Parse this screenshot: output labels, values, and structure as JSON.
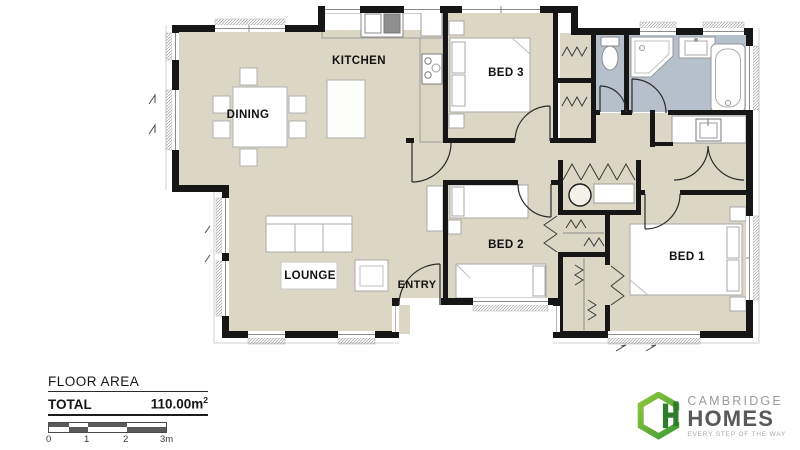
{
  "plan": {
    "rooms": [
      {
        "label": "KITCHEN"
      },
      {
        "label": "DINING"
      },
      {
        "label": "BED 3"
      },
      {
        "label": "BED 2"
      },
      {
        "label": "BED 1"
      },
      {
        "label": "LOUNGE"
      },
      {
        "label": "ENTRY"
      }
    ]
  },
  "summary": {
    "heading": "FLOOR AREA",
    "total_label": "TOTAL",
    "total_value": "110.00m",
    "total_exponent": "2"
  },
  "scale_bar": {
    "ticks": [
      "0",
      "1",
      "2",
      "3m"
    ]
  },
  "logo": {
    "brand_top": "CAMBRIDGE",
    "brand_main": "HOMES",
    "tagline": "EVERY STEP OF THE WAY"
  },
  "colors": {
    "floor": "#dcd6c5",
    "bathroom_floor": "#b6c0cb",
    "wall": "#161616",
    "logo_green_light": "#8dc63f",
    "logo_green_dark": "#3f9c35"
  }
}
